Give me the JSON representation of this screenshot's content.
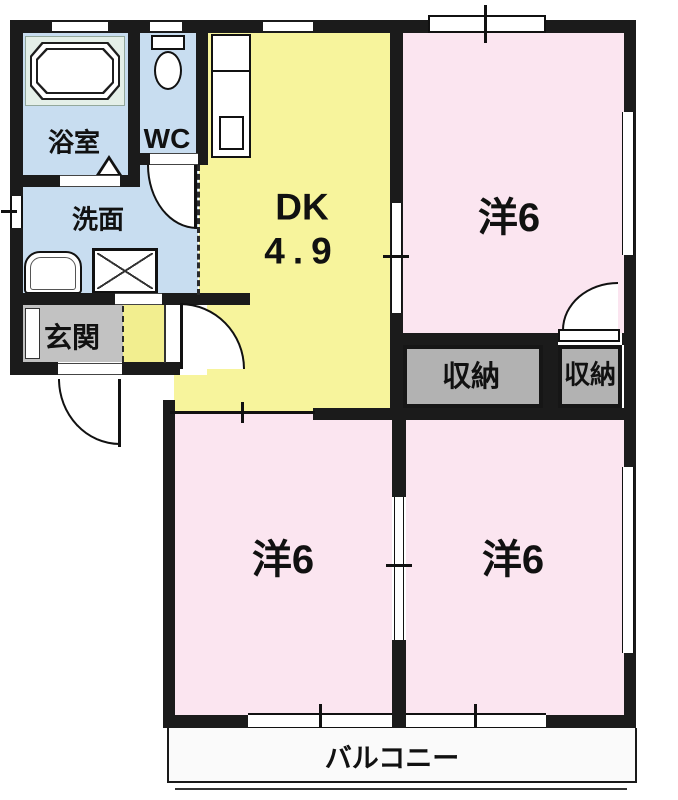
{
  "plan_title": "2DK apartment floor plan",
  "colors": {
    "wall": "#1b1b1b",
    "water_area_blue": "#c8ddf0",
    "dk_yellow": "#f7f49c",
    "hall_yellow": "#f2ee8f",
    "bedroom_pink": "#fbe5f0",
    "closet_gray": "#b2b2b2",
    "entrance_gray": "#c2c2c2",
    "bathtub_panel_green": "#e4efe8",
    "balcony_white": "#fafafa"
  },
  "rooms": {
    "bath": {
      "label": "浴室"
    },
    "toilet": {
      "label": "WC"
    },
    "washroom": {
      "label": "洗面"
    },
    "entrance": {
      "label": "玄関"
    },
    "dining_kitchen": {
      "label": "DK",
      "size": "4.9"
    },
    "bedroom_top_right": {
      "label": "洋6"
    },
    "bedroom_bottom_left": {
      "label": "洋6"
    },
    "bedroom_bottom_right": {
      "label": "洋6"
    },
    "closet_left": {
      "label": "収納"
    },
    "closet_right": {
      "label": "収納"
    },
    "balcony": {
      "label": "バルコニー"
    }
  }
}
